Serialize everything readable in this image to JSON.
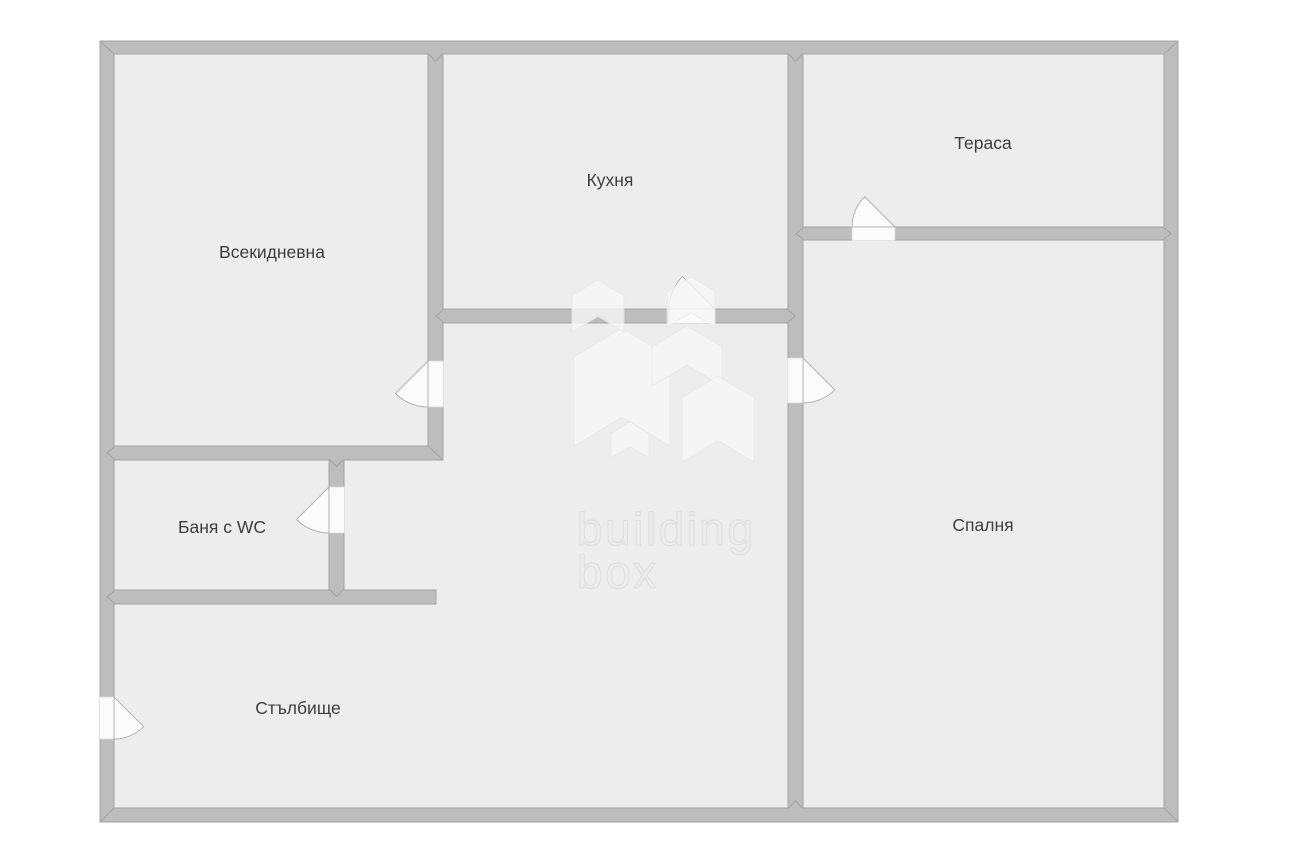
{
  "plan": {
    "rooms": [
      {
        "id": "living-room",
        "label": "Всекидневна"
      },
      {
        "id": "kitchen",
        "label": "Кухня"
      },
      {
        "id": "terrace",
        "label": "Тераса"
      },
      {
        "id": "bathroom-wc",
        "label": "Баня с WC"
      },
      {
        "id": "bedroom",
        "label": "Спалня"
      },
      {
        "id": "staircase",
        "label": "Стълбище"
      }
    ],
    "watermark": {
      "line1": "building",
      "line2": "box"
    },
    "colors": {
      "background": "#ffffff",
      "floor": "#ededed",
      "wall": "#bdbdbd",
      "wall_outline": "#a3a3a3",
      "door_gap": "#fbfbfb",
      "label_text": "#3e3e3e",
      "watermark_text": "#dedede",
      "watermark_logo": "#f7f7f7"
    }
  }
}
